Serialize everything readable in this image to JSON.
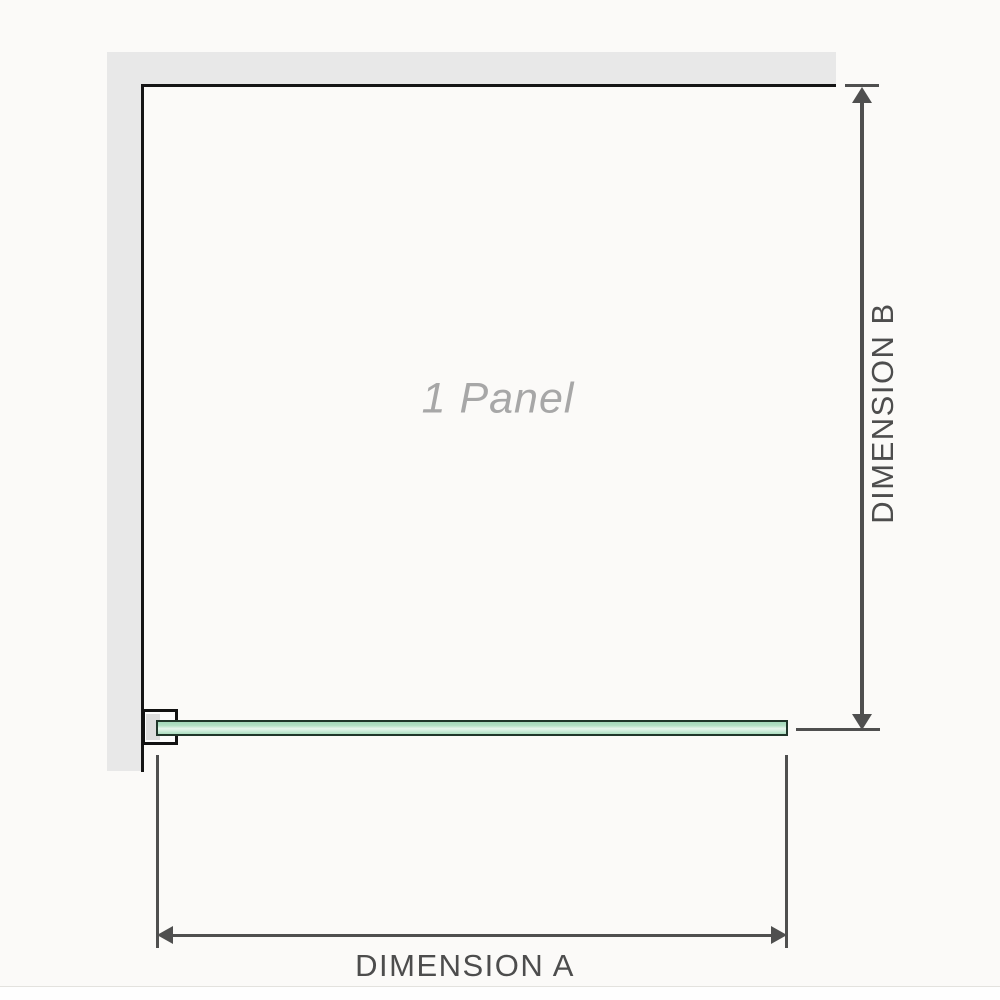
{
  "diagram": {
    "panel_label": "1 Panel",
    "dimension_a_label": "DIMENSION A",
    "dimension_b_label": "DIMENSION B"
  },
  "colors": {
    "background": "#fbfaf8",
    "wall_fill": "#e8e8e8",
    "panel_edge": "#151515",
    "glass_fill": "#b4e1c6",
    "glass_fill_light": "#e9f7ef",
    "glass_border": "#20362a",
    "bracket_border": "#121212",
    "bracket_pad": "#dddddd",
    "dimension_line": "#4f4f4f",
    "dimension_text": "#4d4d4d",
    "panel_label_text": "#a7a7a7",
    "bottom_divider": "#e3e2de"
  }
}
